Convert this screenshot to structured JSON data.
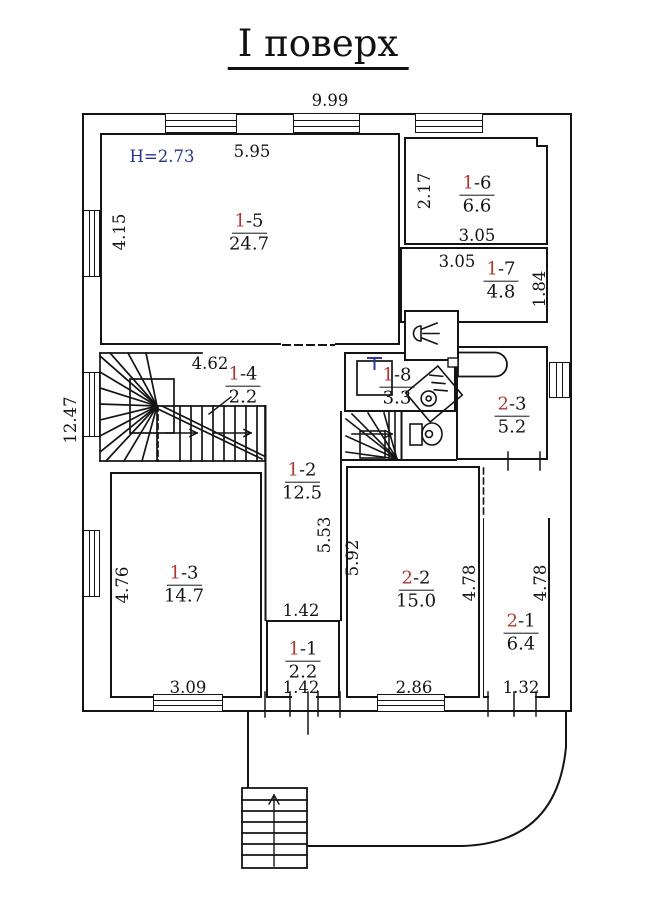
{
  "title": "І поверх",
  "height_note": "H=2.73",
  "rooms": {
    "r11": {
      "head": "1",
      "tail": "-1",
      "area": "2.2"
    },
    "r12": {
      "head": "1",
      "tail": "-2",
      "area": "12.5"
    },
    "r13": {
      "head": "1",
      "tail": "-3",
      "area": "14.7"
    },
    "r14": {
      "head": "1",
      "tail": "-4",
      "area": "2.2"
    },
    "r15": {
      "head": "1",
      "tail": "-5",
      "area": "24.7"
    },
    "r16": {
      "head": "1",
      "tail": "-6",
      "area": "6.6"
    },
    "r17": {
      "head": "1",
      "tail": "-7",
      "area": "4.8"
    },
    "r18": {
      "head": "1",
      "tail": "-8",
      "area": "3.3"
    },
    "r21": {
      "head": "2",
      "tail": "-1",
      "area": "6.4"
    },
    "r22": {
      "head": "2",
      "tail": "-2",
      "area": "15.0"
    },
    "r23": {
      "head": "2",
      "tail": "-3",
      "area": "5.2"
    }
  },
  "dims": {
    "top_width": "9.99",
    "r15_width": "5.95",
    "r15_height": "4.15",
    "left_height": "12.47",
    "r16_height": "2.17",
    "r16_width": "3.05",
    "r17_width": "3.05",
    "r17_height": "1.84",
    "hall_width": "4.62",
    "corridor_height": "5.53",
    "r22_height": "5.92",
    "r13_height": "4.76",
    "r13_width": "3.09",
    "r11_width_top": "1.42",
    "r11_width_bottom": "1.42",
    "r22_width": "2.86",
    "r21_height_left": "4.78",
    "r21_height_right": "4.78",
    "r21_width": "1.32"
  },
  "icons": [
    "shower-head-icon",
    "sink-icon",
    "washing-machine-icon",
    "toilet-icon",
    "bathtub-icon",
    "stair-direction-arrow-icon",
    "exterior-stairs-up-arrow-icon"
  ],
  "colors": {
    "wall": "#141414",
    "room_number_accent": "#ab3832",
    "height_note": "#27348b"
  }
}
